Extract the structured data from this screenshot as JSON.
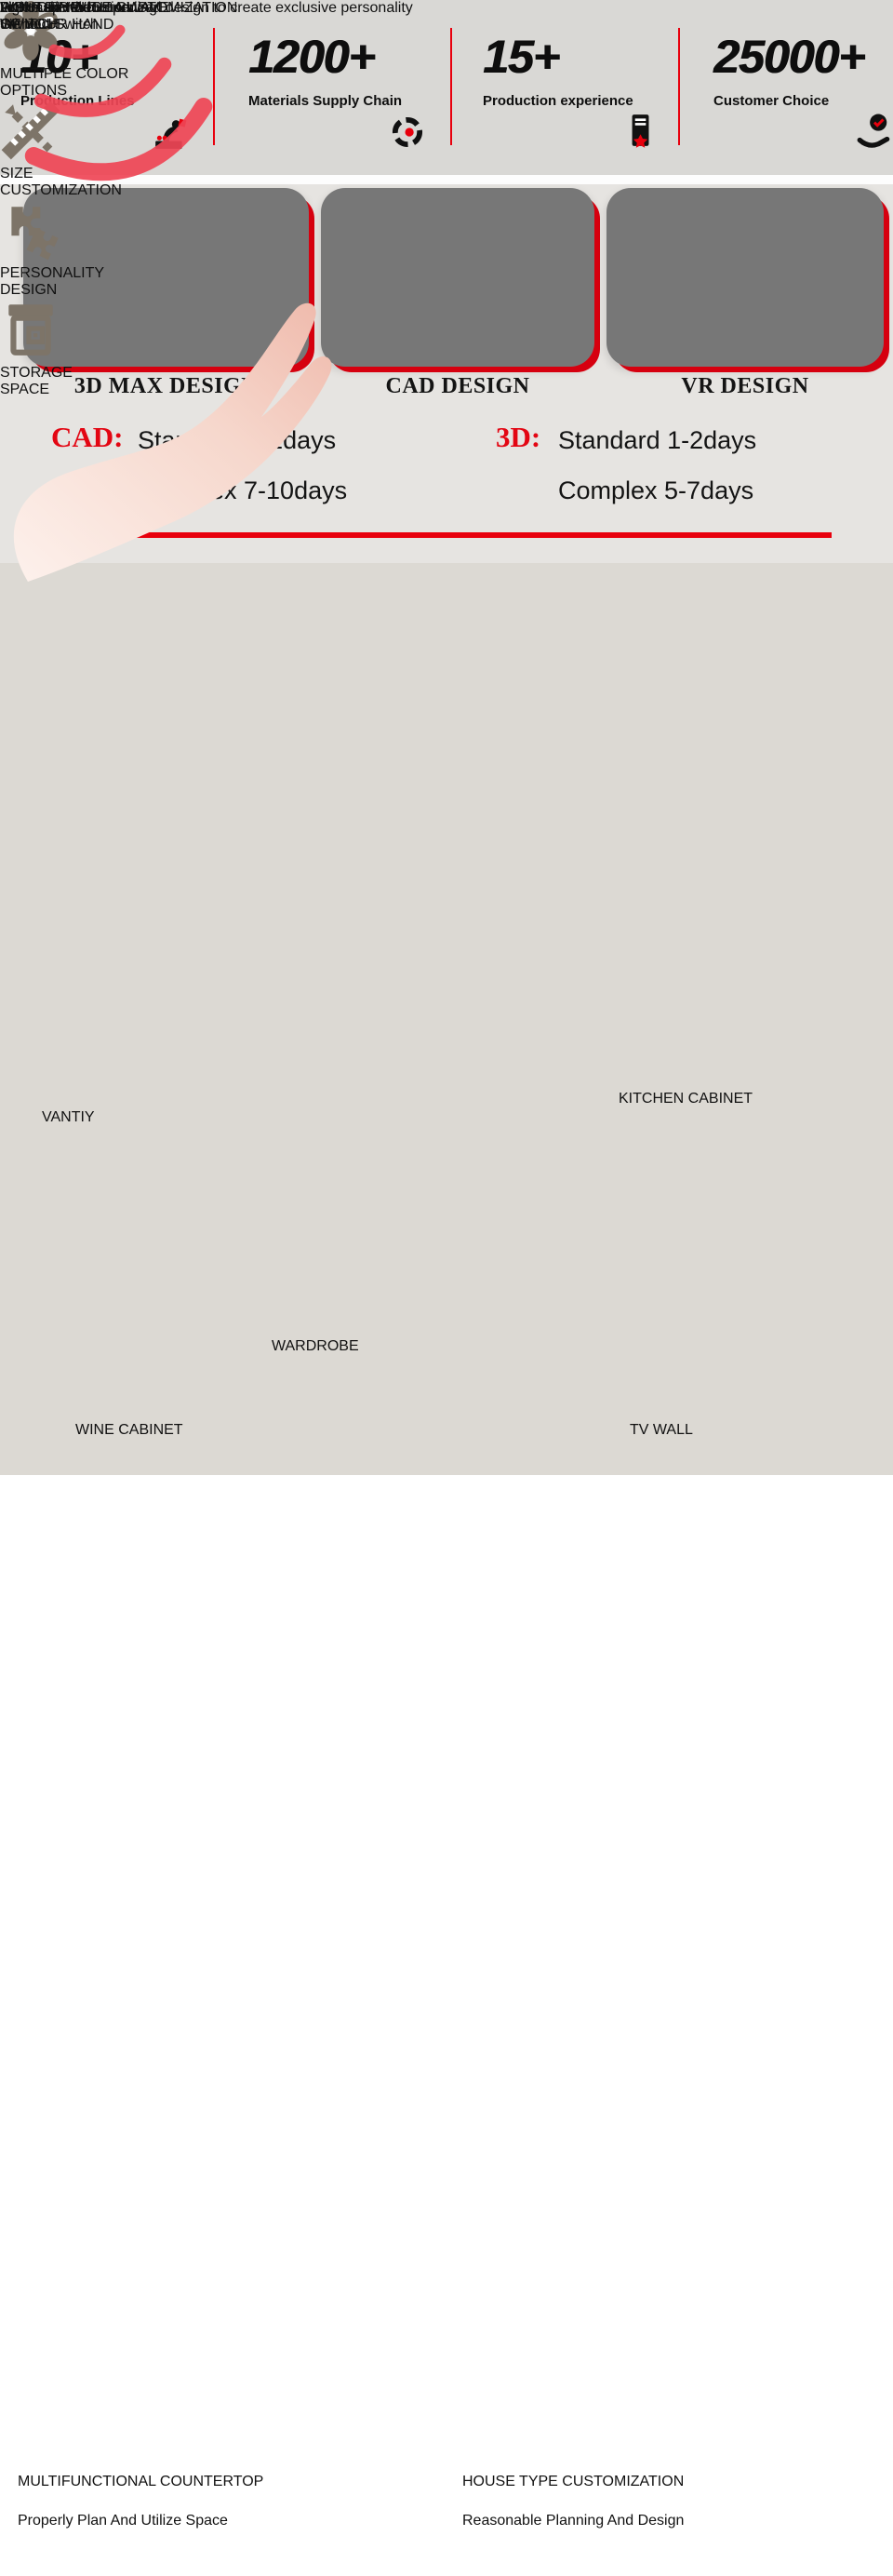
{
  "colors": {
    "accent_red": "#e8000d",
    "icon_taupe": "#7d7468",
    "dot_color": "#7b7067",
    "callout_text": "#6e6e6e"
  },
  "stats": {
    "items": [
      {
        "value": "10+",
        "label": "Production Lines",
        "icon": "robot-arm-icon"
      },
      {
        "value": "1200+",
        "label": "Materials Supply Chain",
        "icon": "supply-chain-icon"
      },
      {
        "value": "15+",
        "label": "Production experience",
        "icon": "production-experience-icon"
      },
      {
        "value": "25000+",
        "label": "Customer Choice",
        "icon": "customer-choice-icon"
      }
    ]
  },
  "design": {
    "cards": [
      {
        "label": "3D MAX DESIGN"
      },
      {
        "label": "CAD DESIGN"
      },
      {
        "label": "VR DESIGN"
      }
    ],
    "schedule": {
      "cad_label": "CAD:",
      "cad_line1": "Standard 1-2days",
      "cad_line2": "Complex 7-10days",
      "d3_label": "3D:",
      "d3_line1": "Standard 1-2days",
      "d3_line2": "Complex 5-7days"
    }
  },
  "whole_house": {
    "title": "WHOLE HOUSE CUSTOMIZATION",
    "subtitle": "Professional customized design to create exclusive personality",
    "carousel_dots": 5,
    "active_dot_index": 2,
    "categories": [
      {
        "label": "VANTIY"
      },
      {
        "label": "KITCHEN CABINET"
      },
      {
        "label": "WARDROBE"
      },
      {
        "label": "WINE CABINET"
      },
      {
        "label": "TV WALL"
      }
    ]
  },
  "features": {
    "items": [
      {
        "icon": "color-options-icon",
        "line1": "MULTIPLE COLOR",
        "line2": "OPTIONS"
      },
      {
        "icon": "size-customization-icon",
        "line1": "SIZE",
        "line2": "CUSTOMIZATION"
      },
      {
        "icon": "personality-design-icon",
        "line1": "PERSONALITY",
        "line2": "DESIGN"
      },
      {
        "icon": "storage-space-icon",
        "line1": "STORAGE",
        "line2": "SPACE"
      }
    ]
  },
  "lighting": {
    "callout1_line1": "LIGHT UP WITH A WAVE",
    "callout1_line2": "OF YOUR HAND",
    "callout2_line1": "INDUCTIVE",
    "callout2_line2": "SWITCH",
    "note1_line1": "Lights up when opening",
    "note1_line2": "the door",
    "note2_line1": "Automatic Induction",
    "note2_line2": "Without Switch"
  },
  "bottom": {
    "items": [
      {
        "title": "MULTIFUNCTIONAL COUNTERTOP",
        "subtitle": "Properly Plan And Utilize Space"
      },
      {
        "title": "HOUSE TYPE CUSTOMIZATION",
        "subtitle": "Reasonable Planning And Design"
      }
    ]
  }
}
